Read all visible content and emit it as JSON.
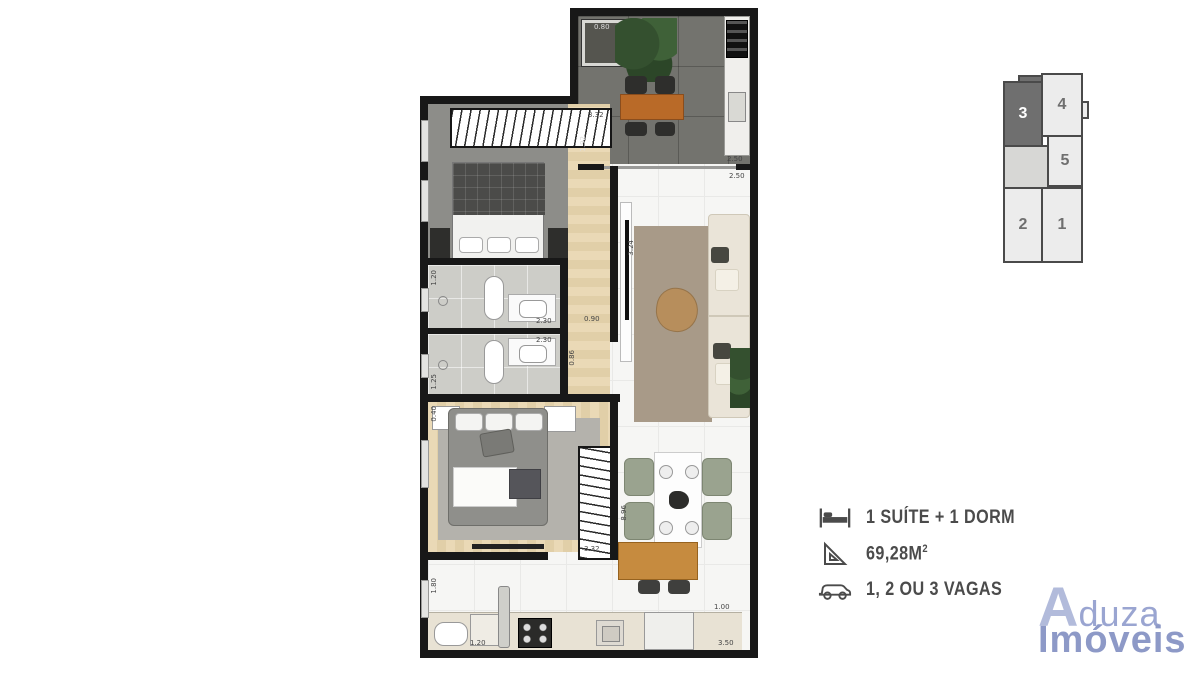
{
  "key_plan": {
    "units": [
      {
        "label": "3"
      },
      {
        "label": "4"
      },
      {
        "label": "5"
      },
      {
        "label": "2"
      },
      {
        "label": "1"
      }
    ]
  },
  "details": {
    "rooms": "1 SUÍTE + 1 DORM",
    "area": "69,28M",
    "area_exponent": "2",
    "parking": "1, 2 OU 3 VAGAS"
  },
  "logo": {
    "initial": "A",
    "name_rest": "duza",
    "line2": "Imóveis"
  },
  "floorplan": {
    "dims": {
      "planter": "0.80",
      "terrace_left": "1.92",
      "suite_closet": "3.32",
      "living_right_a": "2.50",
      "living_right_b": "2.50",
      "living_left": "3.24",
      "bath1_height": "1.20",
      "bath1_width": "2.30",
      "bath2_width": "2.30",
      "bath2_height": "1.25",
      "hall_width": "0.90",
      "hall_height": "0.86",
      "overall_length": "8.96",
      "wardrobe": "3.32",
      "bed2_corner": "0.40",
      "laundry_height": "1.80",
      "laundry_width": "1.20",
      "kitchen_width": "3.50",
      "entry": "1.00"
    }
  },
  "colors": {
    "logo_blue": "#97a2ce",
    "highlight_unit": "#6f6f6f",
    "text_gray": "#4b4b4b"
  }
}
